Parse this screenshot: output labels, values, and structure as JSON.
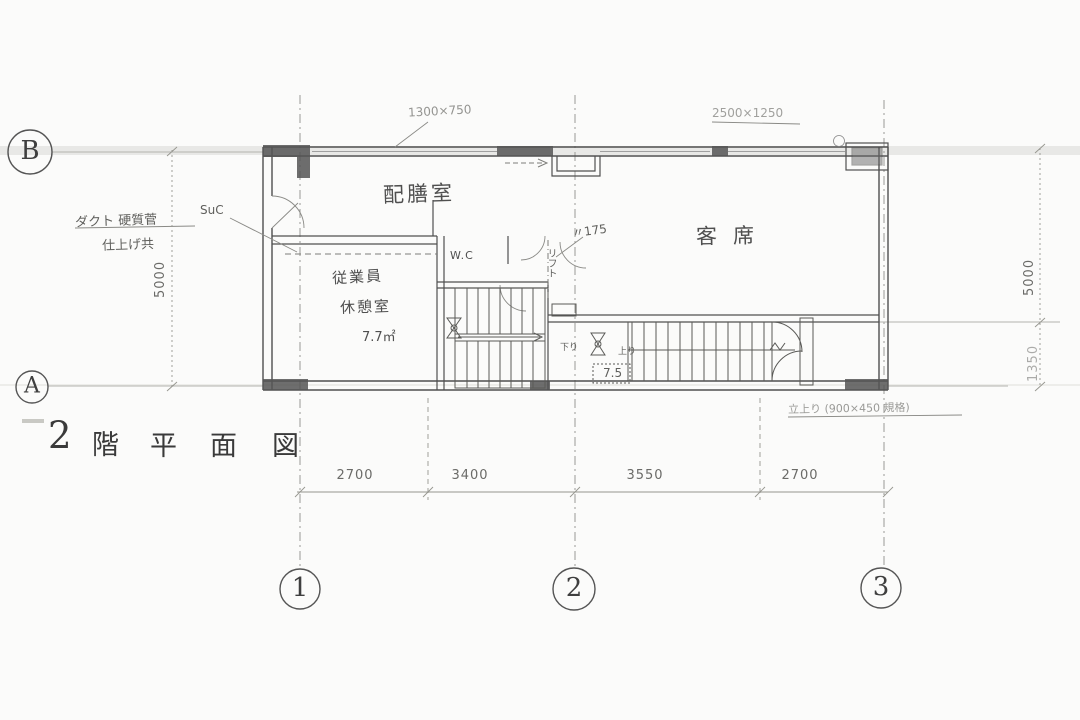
{
  "sheet": {
    "title_text": "2階平面図",
    "title_chars": [
      "2",
      "階",
      "平",
      "面",
      "図"
    ]
  },
  "grid": {
    "rows": [
      {
        "label": "B"
      },
      {
        "label": "A"
      }
    ],
    "cols": [
      {
        "label": "1"
      },
      {
        "label": "2"
      },
      {
        "label": "3"
      }
    ]
  },
  "dimensions": {
    "bottom": [
      "2700",
      "3400",
      "3550",
      "2700"
    ],
    "left": [
      "5000"
    ],
    "right": [
      "5000",
      "1350"
    ]
  },
  "rooms": {
    "pantry": {
      "label": "配膳室"
    },
    "guest": {
      "label": "客席"
    },
    "staff": {
      "line1": "従業員",
      "line2": "休憩室",
      "area": "7.7㎡"
    },
    "wc": {
      "label": "W.C"
    }
  },
  "annotations": {
    "window_left": "1300×750",
    "window_right": "2500×1250",
    "duct_line1": "ダクト 硬質菅",
    "duct_line2": "仕上げ共",
    "duct_tag": "SuC",
    "lift_dim": "〃175",
    "lift": "リフト",
    "down": "下り",
    "up": "上り",
    "stair_box": "7.5",
    "sill_note": "立上り (900×450 規格)"
  },
  "colors": {
    "ink": "#4f4f4f",
    "light_ink": "#8a8a86",
    "copy_band": "#e2e2df"
  }
}
